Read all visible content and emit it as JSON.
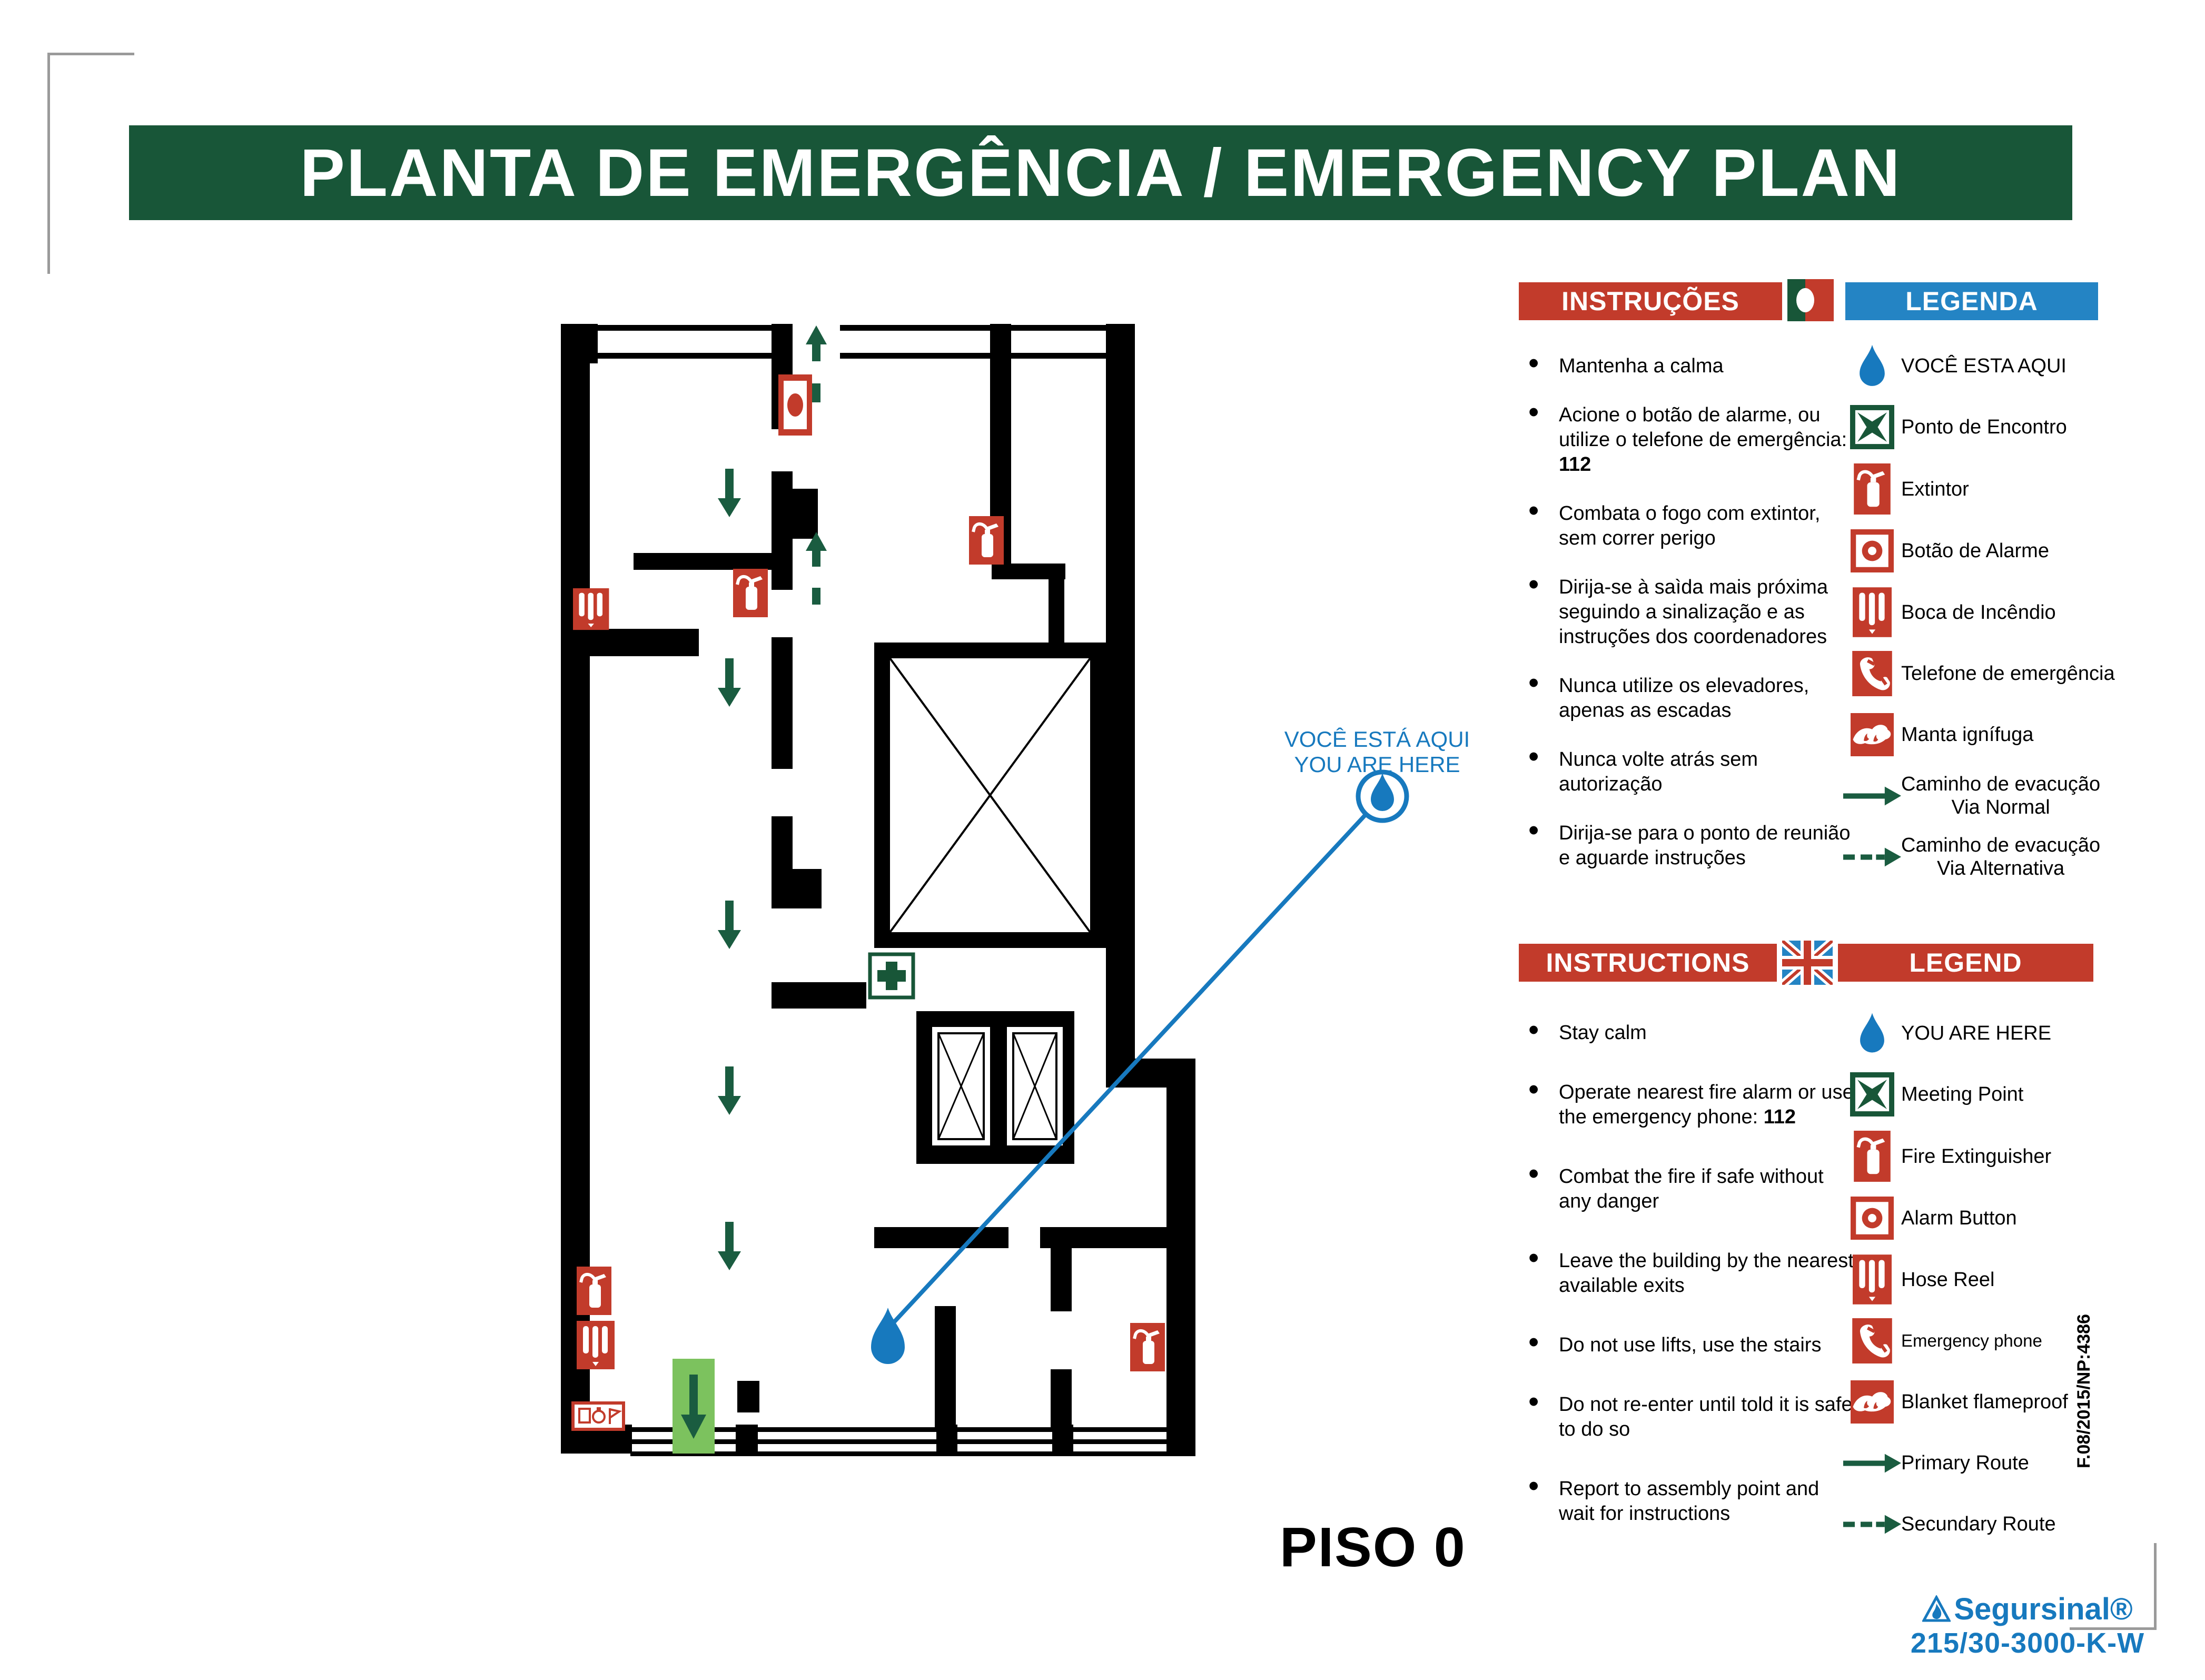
{
  "page": {
    "title": "PLANTA DE EMERGÊNCIA / EMERGENCY PLAN",
    "floor_label": "PISO 0"
  },
  "callout": {
    "line1": "VOCÊ ESTÁ AQUI",
    "line2": "YOU ARE HERE"
  },
  "colors": {
    "header_green": "#185638",
    "red": "#C23B2B",
    "blue_banner": "#2484C4",
    "blue": "#1779BE",
    "route_green": "#1A5C40",
    "exit_green": "#7CC25E"
  },
  "pt": {
    "instructions_title": "INSTRUÇÕES",
    "legend_title": "LEGENDA",
    "flag": "portugal-flag",
    "instructions": [
      {
        "pre": "Mantenha a calma",
        "strong": ""
      },
      {
        "pre": "Acione o botão de alarme, ou utilize o telefone de emergência: ",
        "strong": "112"
      },
      {
        "pre": "Combata o fogo com extintor, sem correr perigo",
        "strong": ""
      },
      {
        "pre": "Dirija-se à saìda mais próxima seguindo a sinalização e as instruções dos coordenadores",
        "strong": ""
      },
      {
        "pre": "Nunca utilize os elevadores, apenas as escadas",
        "strong": ""
      },
      {
        "pre": "Nunca volte atrás sem autorização",
        "strong": ""
      },
      {
        "pre": "Dirija-se para o ponto de reunião e aguarde instruções",
        "strong": ""
      }
    ],
    "legend": [
      {
        "icon": "you-are-here-droplet-icon",
        "label": "VOCÊ ESTA AQUI"
      },
      {
        "icon": "meeting-point-icon",
        "label": "Ponto de Encontro"
      },
      {
        "icon": "fire-extinguisher-icon",
        "label": "Extintor"
      },
      {
        "icon": "alarm-button-icon",
        "label": "Botão de Alarme"
      },
      {
        "icon": "hose-reel-icon",
        "label": "Boca de Incêndio"
      },
      {
        "icon": "emergency-phone-icon",
        "label": "Telefone de emergência"
      },
      {
        "icon": "fire-blanket-icon",
        "label": "Manta ignífuga"
      },
      {
        "icon": "primary-route-arrow-icon",
        "label": "Caminho de evacução",
        "label2": "Via Normal"
      },
      {
        "icon": "secondary-route-arrow-icon",
        "label": "Caminho de evacução",
        "label2": "Via Alternativa"
      }
    ]
  },
  "en": {
    "instructions_title": "INSTRUCTIONS",
    "legend_title": "LEGEND",
    "flag": "uk-flag",
    "instructions": [
      {
        "pre": "Stay calm",
        "strong": ""
      },
      {
        "pre": "Operate nearest fire alarm or use the emergency phone: ",
        "strong": "112"
      },
      {
        "pre": "Combat the fire if safe without any danger",
        "strong": ""
      },
      {
        "pre": "Leave the building by the nearest available exits",
        "strong": ""
      },
      {
        "pre": "Do not use lifts, use the stairs",
        "strong": ""
      },
      {
        "pre": "Do not re-enter until told it is safe to do so",
        "strong": ""
      },
      {
        "pre": "Report to assembly point and wait for instructions",
        "strong": ""
      }
    ],
    "legend": [
      {
        "icon": "you-are-here-droplet-icon",
        "label": "YOU ARE HERE"
      },
      {
        "icon": "meeting-point-icon",
        "label": "Meeting Point"
      },
      {
        "icon": "fire-extinguisher-icon",
        "label": "Fire Extinguisher"
      },
      {
        "icon": "alarm-button-icon",
        "label": "Alarm Button"
      },
      {
        "icon": "hose-reel-icon",
        "label": "Hose Reel"
      },
      {
        "icon": "emergency-phone-icon",
        "label": "Emergency phone"
      },
      {
        "icon": "fire-blanket-icon",
        "label": "Blanket flameproof"
      },
      {
        "icon": "primary-route-arrow-icon",
        "label": "Primary Route"
      },
      {
        "icon": "secondary-route-arrow-icon",
        "label": "Secundary Route"
      }
    ]
  },
  "footer": {
    "doc_code": "F.08/2015/NP:4386",
    "brand": "Segursinal®",
    "model": "215/30-3000-K-W"
  }
}
